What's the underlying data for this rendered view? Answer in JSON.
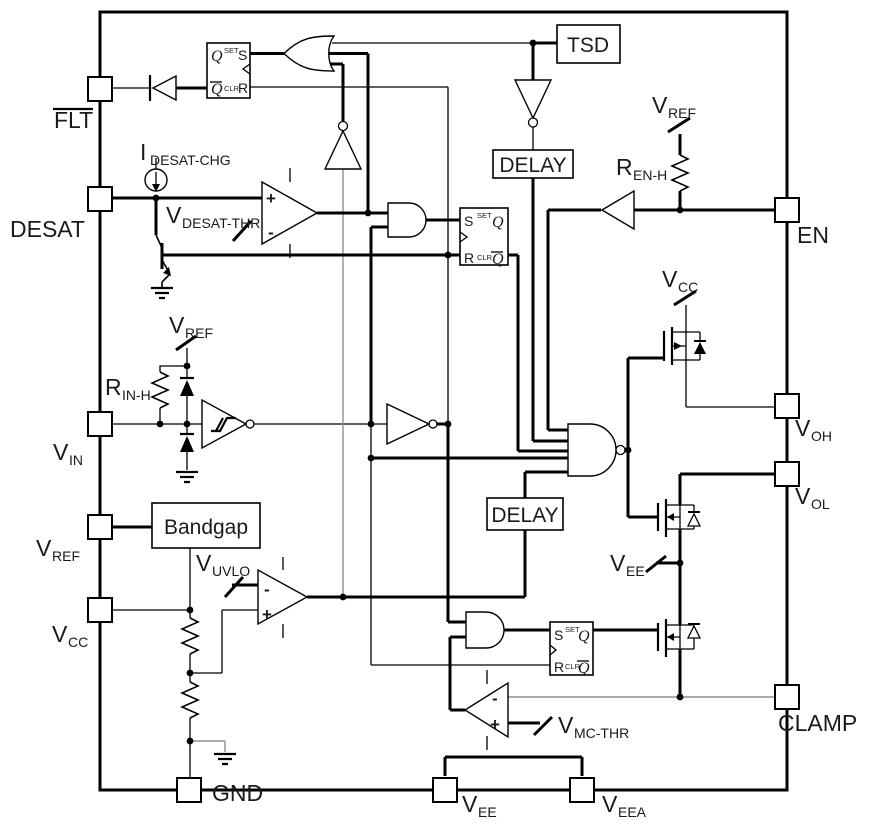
{
  "diagram": {
    "pins": {
      "flt": {
        "label": "FLT"
      },
      "desat": {
        "label": "DESAT"
      },
      "vin": {
        "main": "V",
        "sub": "IN"
      },
      "vref": {
        "main": "V",
        "sub": "REF"
      },
      "vcc": {
        "main": "V",
        "sub": "CC"
      },
      "gnd": {
        "label": "GND"
      },
      "vee": {
        "main": "V",
        "sub": "EE"
      },
      "veea": {
        "main": "V",
        "sub": "EEA"
      },
      "en": {
        "label": "EN"
      },
      "voh": {
        "main": "V",
        "sub": "OH"
      },
      "vol": {
        "main": "V",
        "sub": "OL"
      },
      "clamp": {
        "label": "CLAMP"
      }
    },
    "blocks": {
      "tsd": "TSD",
      "delay_top": "DELAY",
      "delay_bottom": "DELAY",
      "bandgap": "Bandgap"
    },
    "latch": {
      "q": "Q",
      "s": "S",
      "r": "R",
      "set": "SET",
      "clr": "CLR"
    },
    "nets": {
      "idesat_chg": {
        "main": "I",
        "sub": "DESAT-CHG"
      },
      "vdesat_thr": {
        "main": "V",
        "sub": "DESAT-THR"
      },
      "vref_in": {
        "main": "V",
        "sub": "REF"
      },
      "rin_h": {
        "main": "R",
        "sub": "IN-H"
      },
      "vuvlo": {
        "main": "V",
        "sub": "UVLO"
      },
      "vref_en": {
        "main": "V",
        "sub": "REF"
      },
      "ren_h": {
        "main": "R",
        "sub": "EN-H"
      },
      "vcc_rail": {
        "main": "V",
        "sub": "CC"
      },
      "vee_rail": {
        "main": "V",
        "sub": "EE"
      },
      "vmc_thr": {
        "main": "V",
        "sub": "MC-THR"
      }
    },
    "symbols": {
      "plus": "+",
      "minus": "-"
    }
  }
}
